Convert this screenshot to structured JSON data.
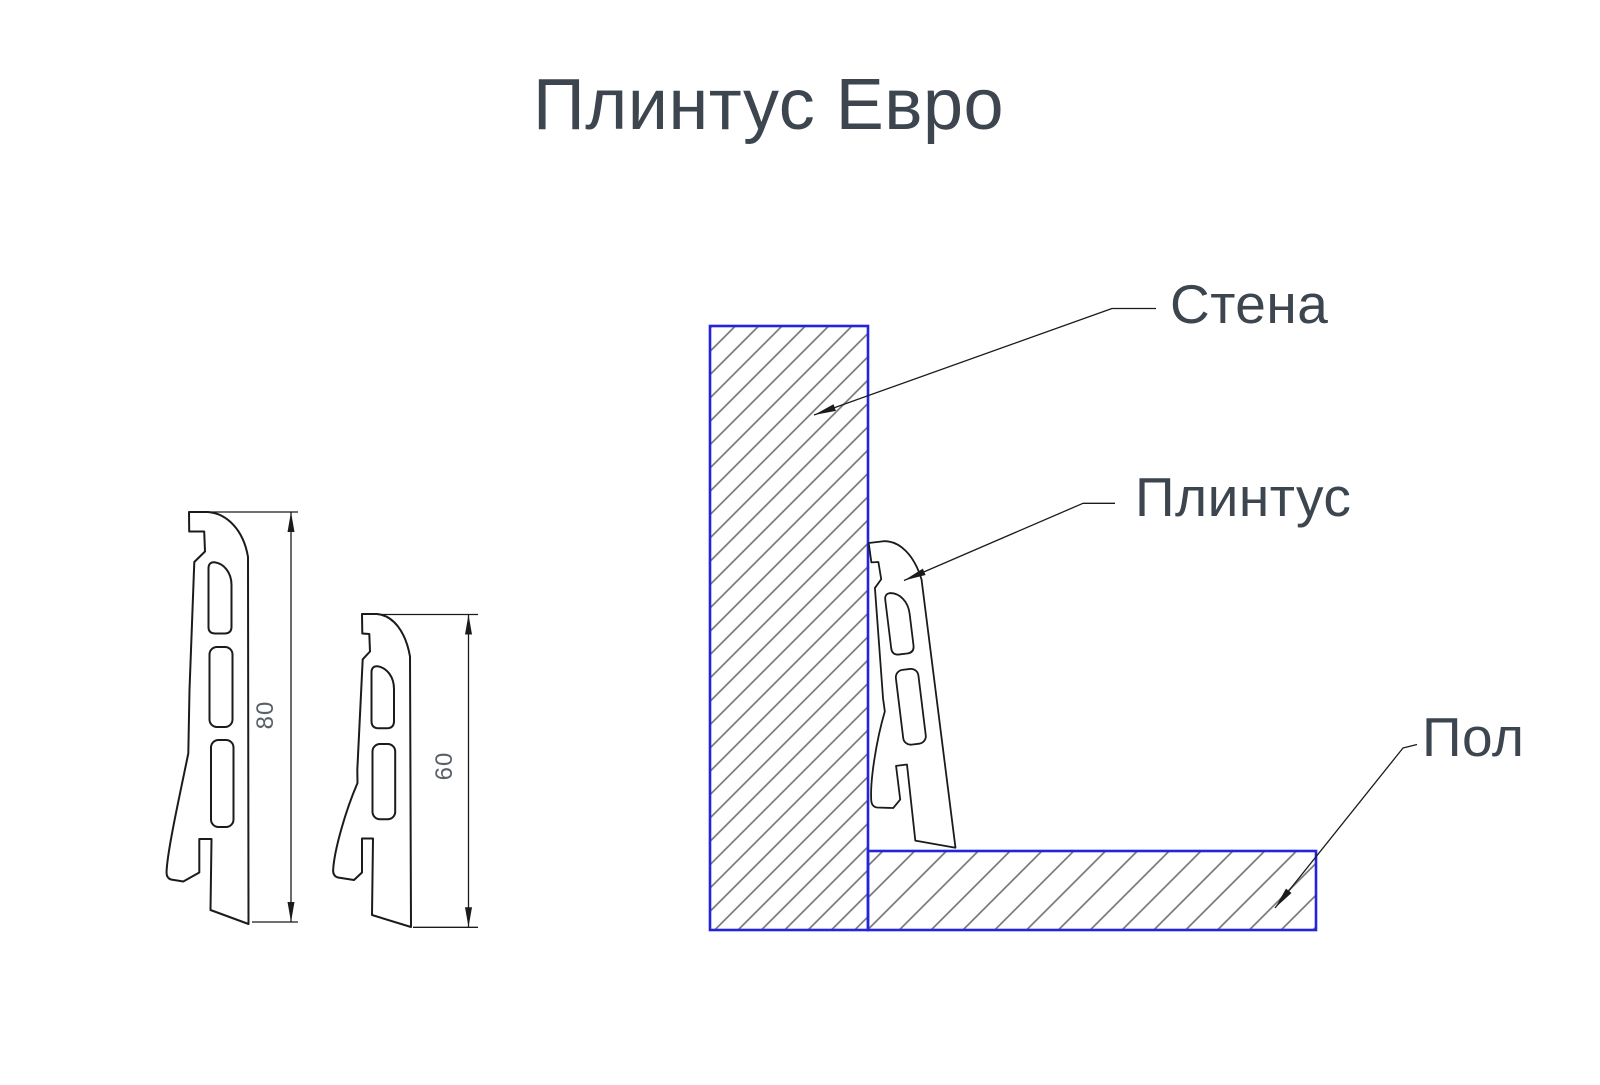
{
  "title": "Плинтус Евро",
  "callouts": {
    "wall": "Стена",
    "plinth": "Плинтус",
    "floor": "Пол"
  },
  "profiles": {
    "large": {
      "height_label": "80"
    },
    "small": {
      "height_label": "60"
    }
  },
  "colors": {
    "outline": "#1b1b1b",
    "construction": "#2424dd",
    "hatch": "#6f6f6f",
    "text": "#3d454f",
    "dim_text": "#586068"
  }
}
